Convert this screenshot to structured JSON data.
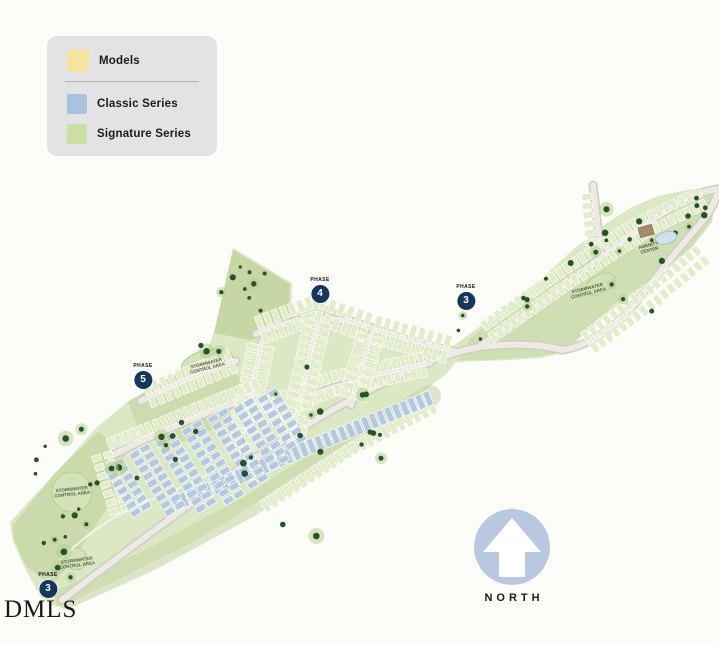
{
  "legend": {
    "items": [
      {
        "label": "Models"
      },
      {
        "label": "Classic Series"
      },
      {
        "label": "Signature Series"
      }
    ]
  },
  "phases": [
    {
      "label": "PHASE",
      "number": "4"
    },
    {
      "label": "PHASE",
      "number": "3"
    },
    {
      "label": "PHASE",
      "number": "5"
    },
    {
      "label": "PHASE",
      "number": "3"
    }
  ],
  "map_labels": {
    "stormwater": "STORMWATER CONTROL AREA",
    "amenity": "AMENITY CENTER"
  },
  "compass": {
    "label": "NORTH"
  },
  "watermark": "DMLS",
  "icons": {
    "north_arrow": "arrow-up",
    "tree_dot": "filled-circle"
  },
  "colors": {
    "background": "#fcfcf9",
    "legend_bg": "#e3e3e5",
    "models_swatch": "#f6e3a0",
    "classic_swatch": "#a9c2de",
    "signature_swatch": "#cbdf9e",
    "land": "#dce8c4",
    "land_dark": "#c6d6a5",
    "lot_green": "#e3edc9",
    "lot_blue": "#b3c8e2",
    "road": "#eceae2",
    "road_edge": "#cfcdc5",
    "tree": "#27522e",
    "tree_halo": "#b8cf92",
    "pond": "#d3e2b8",
    "pool": "#cfe0ef",
    "building": "#a98a6a",
    "phase_badge": "#16375c",
    "north_circle": "#b8c9df"
  }
}
